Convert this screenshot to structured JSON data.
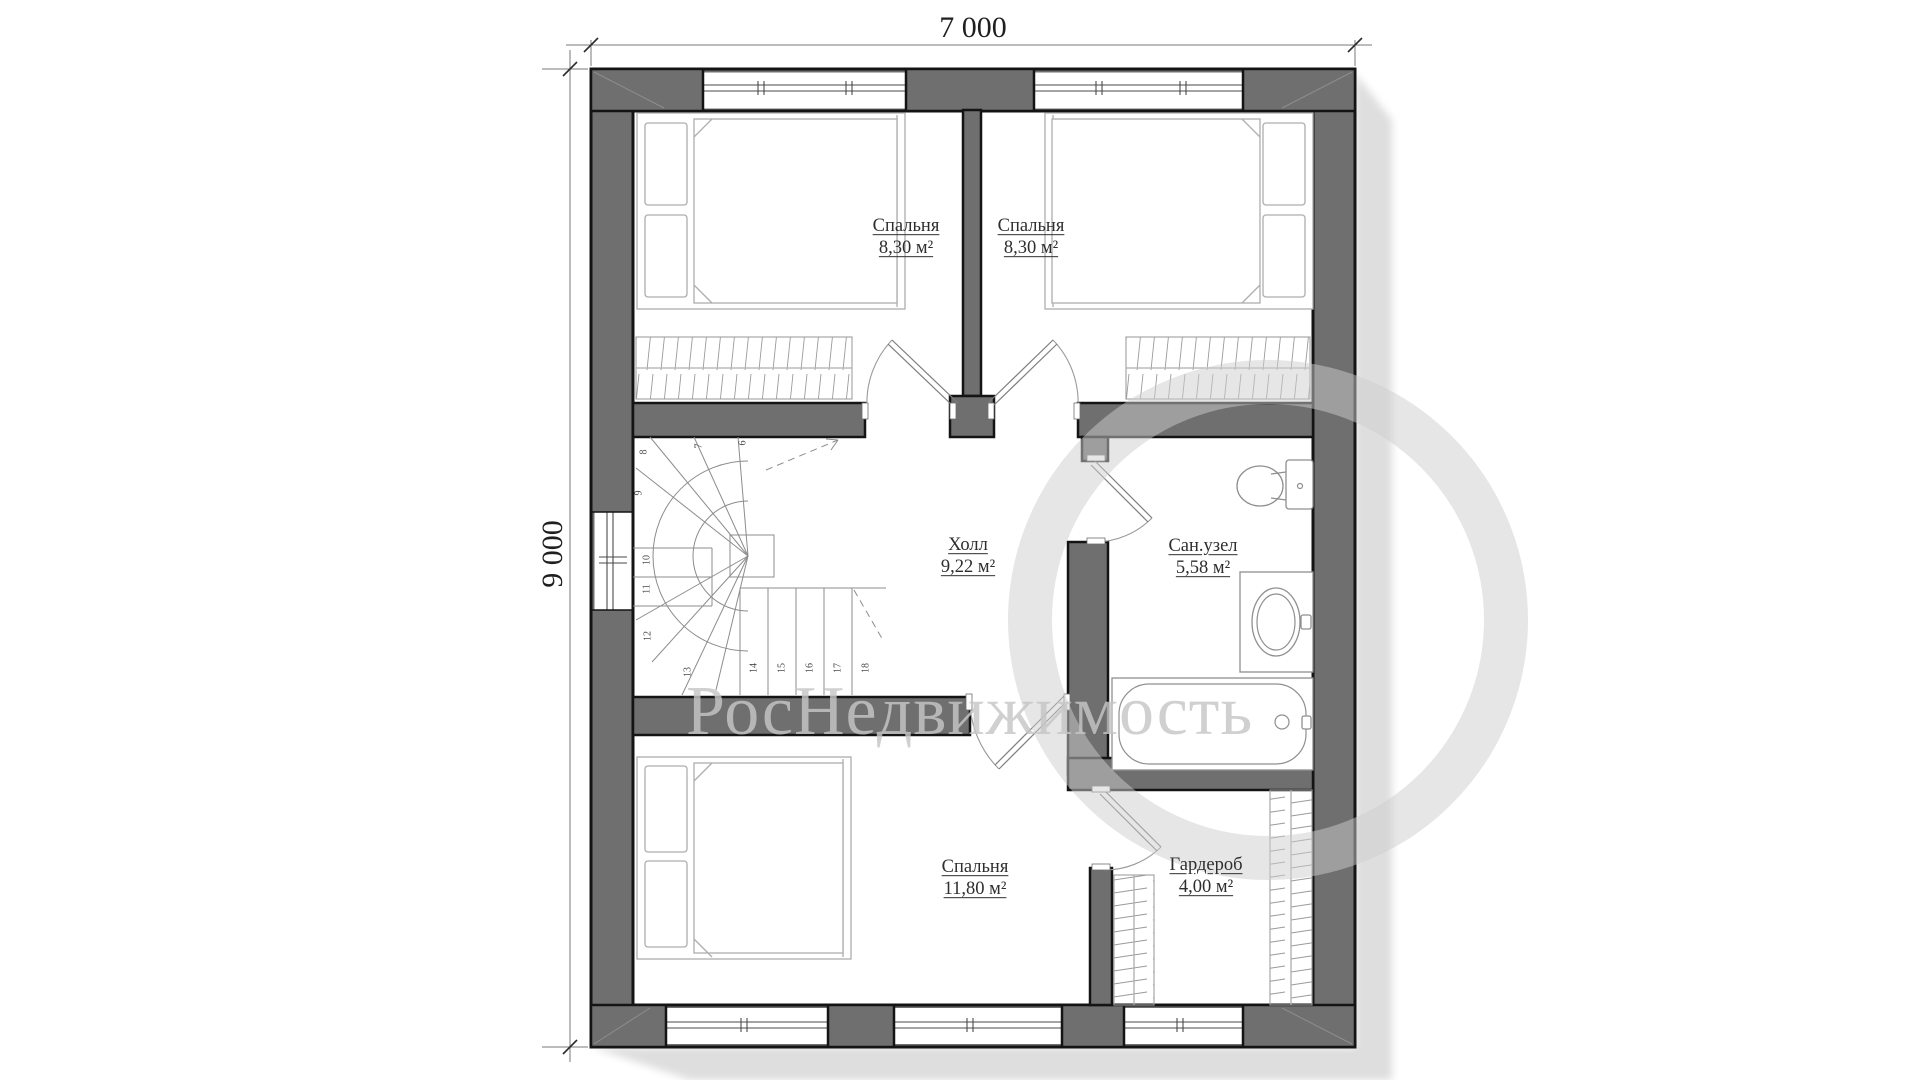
{
  "plan": {
    "dimension_width": "7 000",
    "dimension_height": "9 000",
    "rooms": [
      {
        "id": "bedroom-top-left",
        "name": "Спальня",
        "area": "8,30 м²"
      },
      {
        "id": "bedroom-top-right",
        "name": "Спальня",
        "area": "8,30 м²"
      },
      {
        "id": "hall",
        "name": "Холл",
        "area": "9,22 м²"
      },
      {
        "id": "bathroom",
        "name": "Сан.узел",
        "area": "5,58 м²"
      },
      {
        "id": "bedroom-bottom",
        "name": "Спальня",
        "area": "11,80 м²"
      },
      {
        "id": "wardrobe",
        "name": "Гардероб",
        "area": "4,00 м²"
      }
    ],
    "stair_steps": [
      "6",
      "7",
      "8",
      "9",
      "10",
      "11",
      "12",
      "13",
      "14",
      "15",
      "16",
      "17",
      "18"
    ],
    "watermark": "РосНедвижимость",
    "colors": {
      "wall_fill": "#6f6f6f",
      "wall_outline": "#141414",
      "shadow": "#dedede",
      "furniture_line": "#aeaeae",
      "door_line": "#9a9a9a",
      "stair_line": "#8c8c8c",
      "watermark_gray": "#c6c6c6",
      "label_text": "#2e2e2e"
    }
  }
}
